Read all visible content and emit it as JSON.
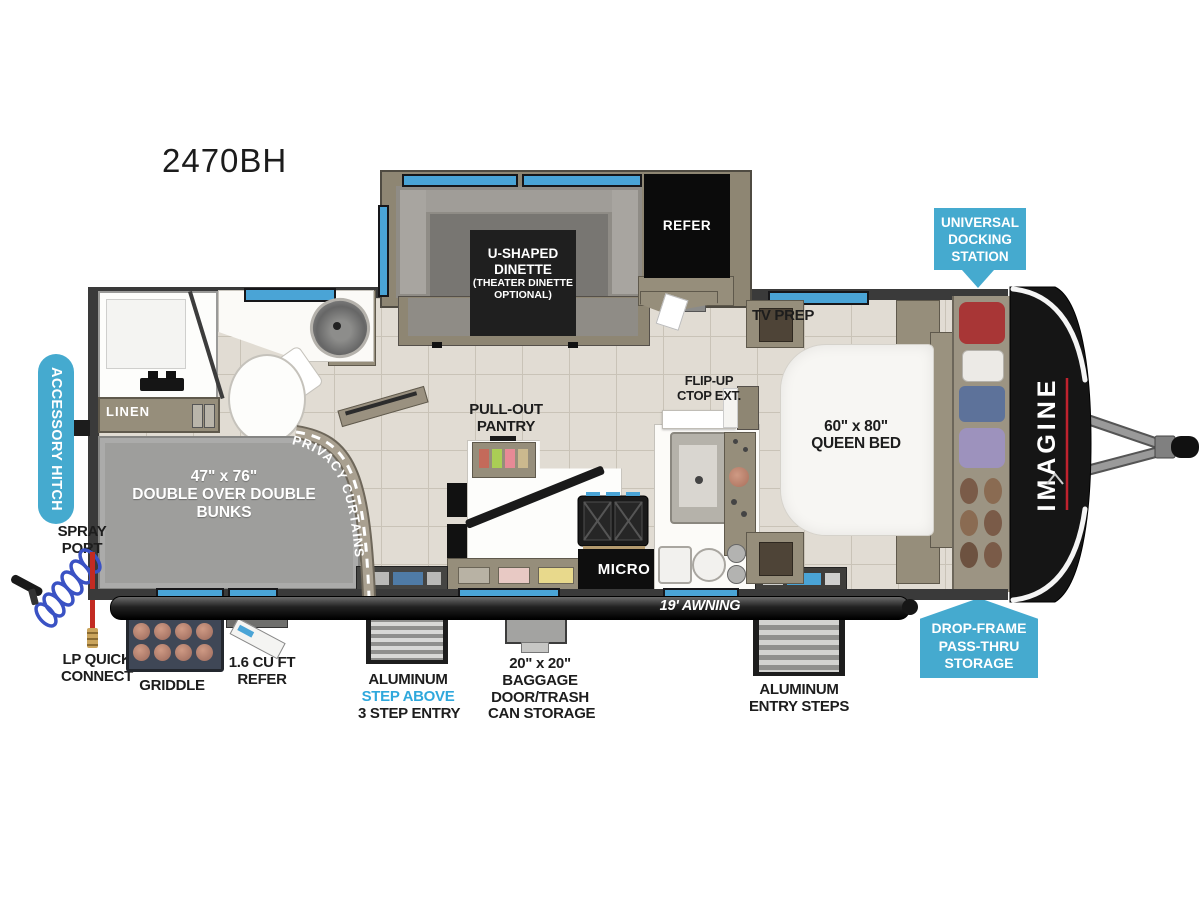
{
  "title": "2470BH",
  "colors": {
    "accent_blue": "#45aacf",
    "window_blue": "#4aa4d6",
    "slide_tan": "#8e8673",
    "bunk_gray": "#9e9e9c",
    "cap_black": "#141414",
    "brand_red": "#c0222e",
    "step_above_blue": "#2fa8dc"
  },
  "plan": {
    "dinette": {
      "line1": "U-SHAPED",
      "line2": "DINETTE",
      "line3": "(THEATER DINETTE",
      "line4": "OPTIONAL)"
    },
    "refer": "REFER",
    "tv_prep": "TV PREP",
    "flip_up": {
      "line1": "FLIP-UP",
      "line2": "CTOP EXT."
    },
    "queen_bed": {
      "line1": "60\" x 80\"",
      "line2": "QUEEN BED"
    },
    "linen": "LINEN",
    "bunks": {
      "line1": "47\" x 76\"",
      "line2": "DOUBLE OVER DOUBLE",
      "line3": "BUNKS"
    },
    "privacy_curtains": "PRIVACY CURTAINS",
    "pantry": {
      "line1": "PULL-OUT",
      "line2": "PANTRY"
    },
    "micro": "MICRO",
    "awning": "19' AWNING",
    "brand": "IMAGINE"
  },
  "badges": {
    "universal_docking": {
      "line1": "UNIVERSAL",
      "line2": "DOCKING",
      "line3": "STATION"
    },
    "accessory_hitch": "ACCESSORY HITCH",
    "drop_frame": {
      "line1": "DROP-FRAME",
      "line2": "PASS-THRU",
      "line3": "STORAGE"
    }
  },
  "exterior_labels": {
    "spray_port": {
      "line1": "SPRAY",
      "line2": "PORT"
    },
    "lp_quick_connect": {
      "line1": "LP QUICK",
      "line2": "CONNECT"
    },
    "griddle": "GRIDDLE",
    "mini_refer": {
      "line1": "1.6 CU FT",
      "line2": "REFER"
    },
    "step_entry": {
      "line1": "ALUMINUM",
      "line2": "STEP ABOVE",
      "line3": "3 STEP ENTRY"
    },
    "baggage": {
      "line1": "20\" x 20\"",
      "line2": "BAGGAGE",
      "line3": "DOOR/TRASH",
      "line4": "CAN STORAGE"
    },
    "entry_steps": {
      "line1": "ALUMINUM",
      "line2": "ENTRY STEPS"
    }
  }
}
